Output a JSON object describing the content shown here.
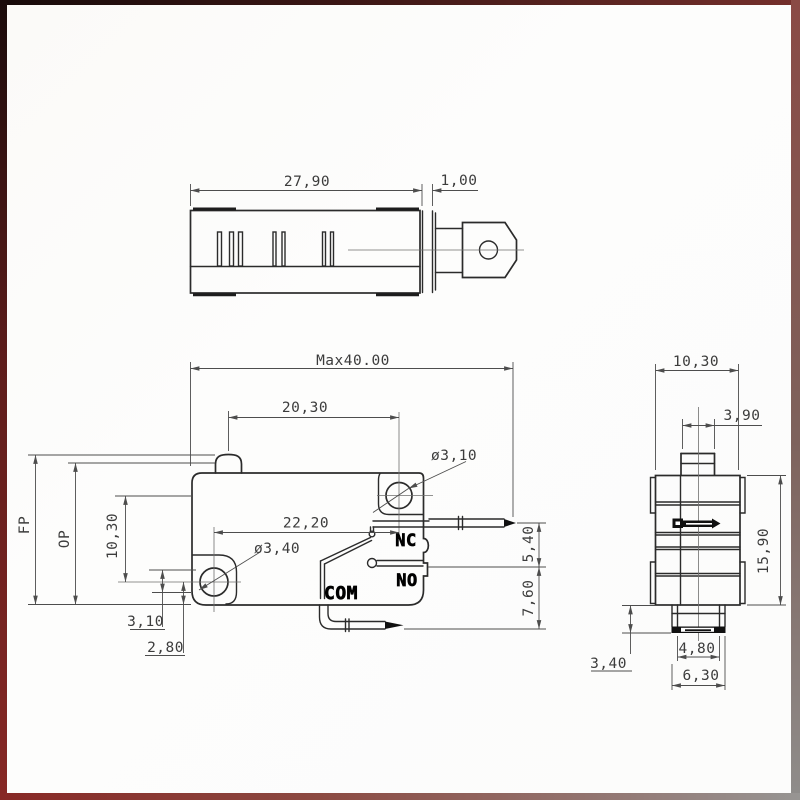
{
  "top_view": {
    "length": "27,90",
    "tip_offset": "1,00"
  },
  "front_view": {
    "overall_max": "Max40.00",
    "plunger_to_hole": "20,30",
    "holes_horizontal": "22,20",
    "hole_diameter_top": "ø3,10",
    "hole_diameter_bottom": "ø3,40",
    "free_position": "FP",
    "operating_position": "OP",
    "holes_vertical": "10,30",
    "dim_3_10": "3,10",
    "dim_2_80": "2,80",
    "terminal_nc": "NC",
    "terminal_no": "NO",
    "terminal_com": "COM",
    "dim_5_40": "5,40",
    "dim_7_60": "7,60"
  },
  "side_view": {
    "width": "10,30",
    "plunger_width": "3,90",
    "height": "15,90",
    "base_height": "3,40",
    "base_inner_width": "4,80",
    "base_outer_width": "6,30"
  },
  "colors": {
    "line": "#2b2b2b",
    "dimension": "#4d4d4d",
    "frame_maroon": "#872825",
    "frame_gray": "#8f8d8b",
    "paper": "#fcfcfb"
  }
}
